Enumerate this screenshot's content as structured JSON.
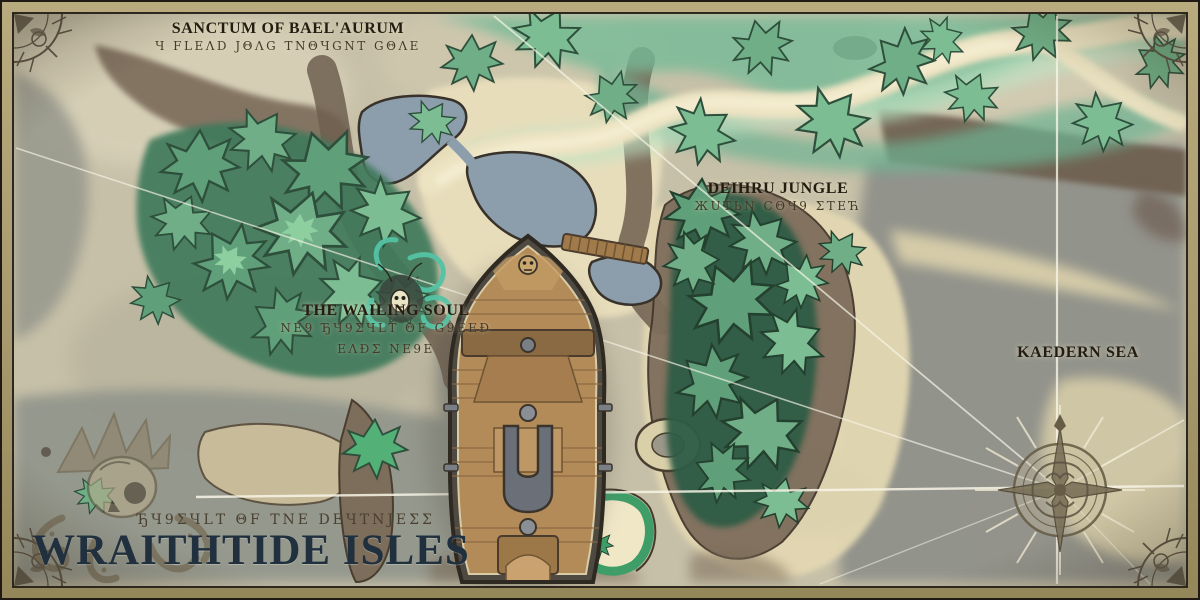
{
  "map": {
    "title": "WRAITHTIDE ISLES",
    "title_runes": "ЂЧ9ΣЧLТ ΘF ТΝΕ DΕЧТΝЈΕΣΣ",
    "labels": {
      "sanctum": {
        "title": "SANCTUM OF BAEL'AURUM",
        "runes": "Ч FLΕΛD JΘΛG ТΝΘЧGΝТ GΘΛΕ"
      },
      "jungle": {
        "title": "DEIHRU JUNGLE",
        "runes": "ЖUТЬΝ СΘЧ9 ΣТΕЋ"
      },
      "wailing": {
        "title": "THE WAILING SOUL",
        "runes1": "ΝΕ9 ЂЧ9ΣЧLТ ΘF G9ΕΕÐ",
        "runes2": "ΕΛÐΣ ΝΕ9Ε"
      },
      "sea": {
        "title": "KAEDERN SEA"
      }
    },
    "colors": {
      "parchment": "#c7c0a8",
      "sea_gray": "#94958a",
      "sand": "#e7ddbb",
      "forest_dark": "#3f7a5b",
      "forest_mid": "#5fa07a",
      "forest_light": "#8ecf9f",
      "marsh": "#74bb97",
      "lake_blue": "#8c9dab",
      "cliff_brown": "#7d6d5b",
      "ship_deck": "#b38b58",
      "ink_title": "#20303f",
      "compass_sepia": "#675d46",
      "survey_line": "#f8f5e6"
    }
  }
}
